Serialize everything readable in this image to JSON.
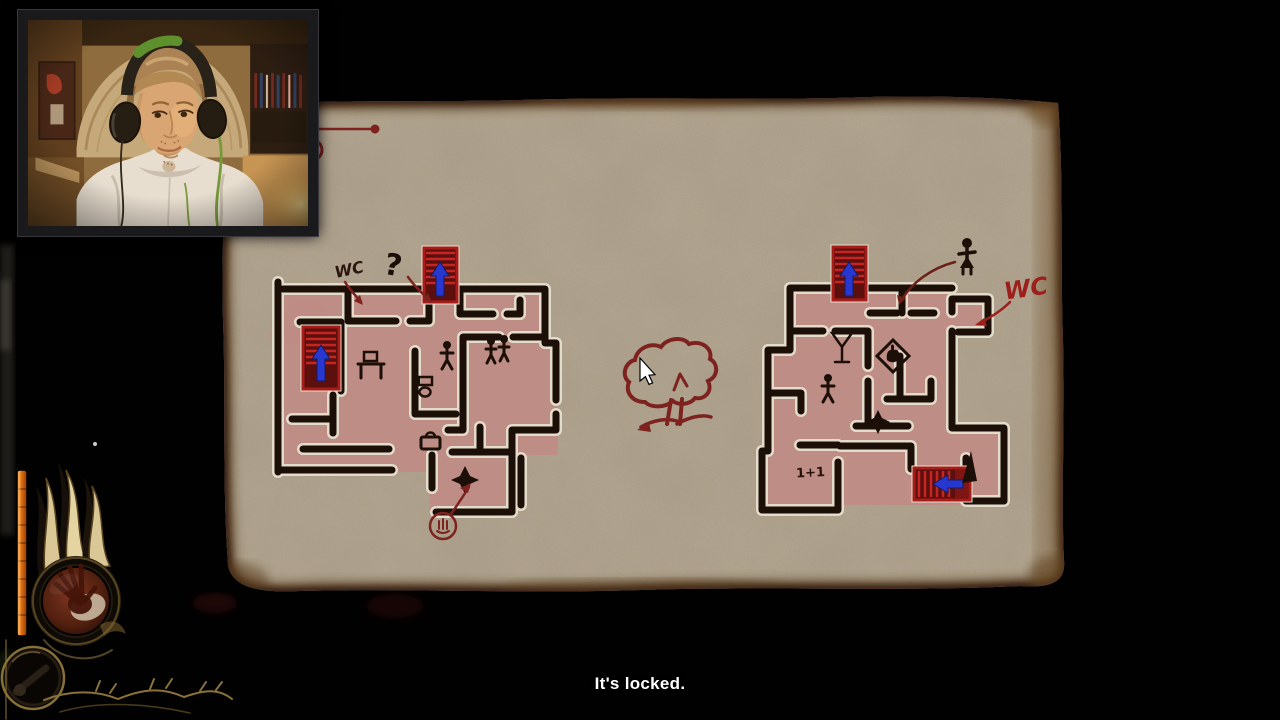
{
  "subtitle": {
    "text": "It's locked."
  },
  "map_screen": {
    "left_floorplan": {
      "wc_label": "WC",
      "question_label": "?",
      "icons": [
        "stairs-up-icon",
        "stairs-up-icon",
        "person-icon",
        "two-people-icon",
        "bench-icon",
        "toilet-icon",
        "bag-icon",
        "star-room-icon",
        "circled-hand-icon"
      ]
    },
    "right_floorplan": {
      "wc_label": "WC",
      "unit_label": "1+1",
      "icons": [
        "stairs-up-icon",
        "stairs-left-icon",
        "martini-icon",
        "hand-card-icon",
        "person-icon",
        "star-room-icon",
        "walking-figure-icon",
        "triangle-arrow-icon"
      ]
    },
    "center_icon": "tree-sketch-icon",
    "cursor": "arrow-cursor"
  },
  "hud": {
    "power_orb_icon": "demon-hand-icon",
    "item_orb_icon": "item-orb-icon",
    "meter_color": "#e87818"
  },
  "webcam": {
    "icons": [
      "streamer-face",
      "headphones-icon"
    ]
  },
  "colors": {
    "background": "#020101",
    "parchment": "#b5a893",
    "room_fill": "#bf8c85",
    "wall_ink": "#1c0f08",
    "stair_red": "#a81b18",
    "arrow_blue": "#2738d0",
    "sketch_red": "#7e2220",
    "hud_orange": "#e87818",
    "hud_gold": "#8a7238",
    "subtitle_text": "#ffffff"
  }
}
